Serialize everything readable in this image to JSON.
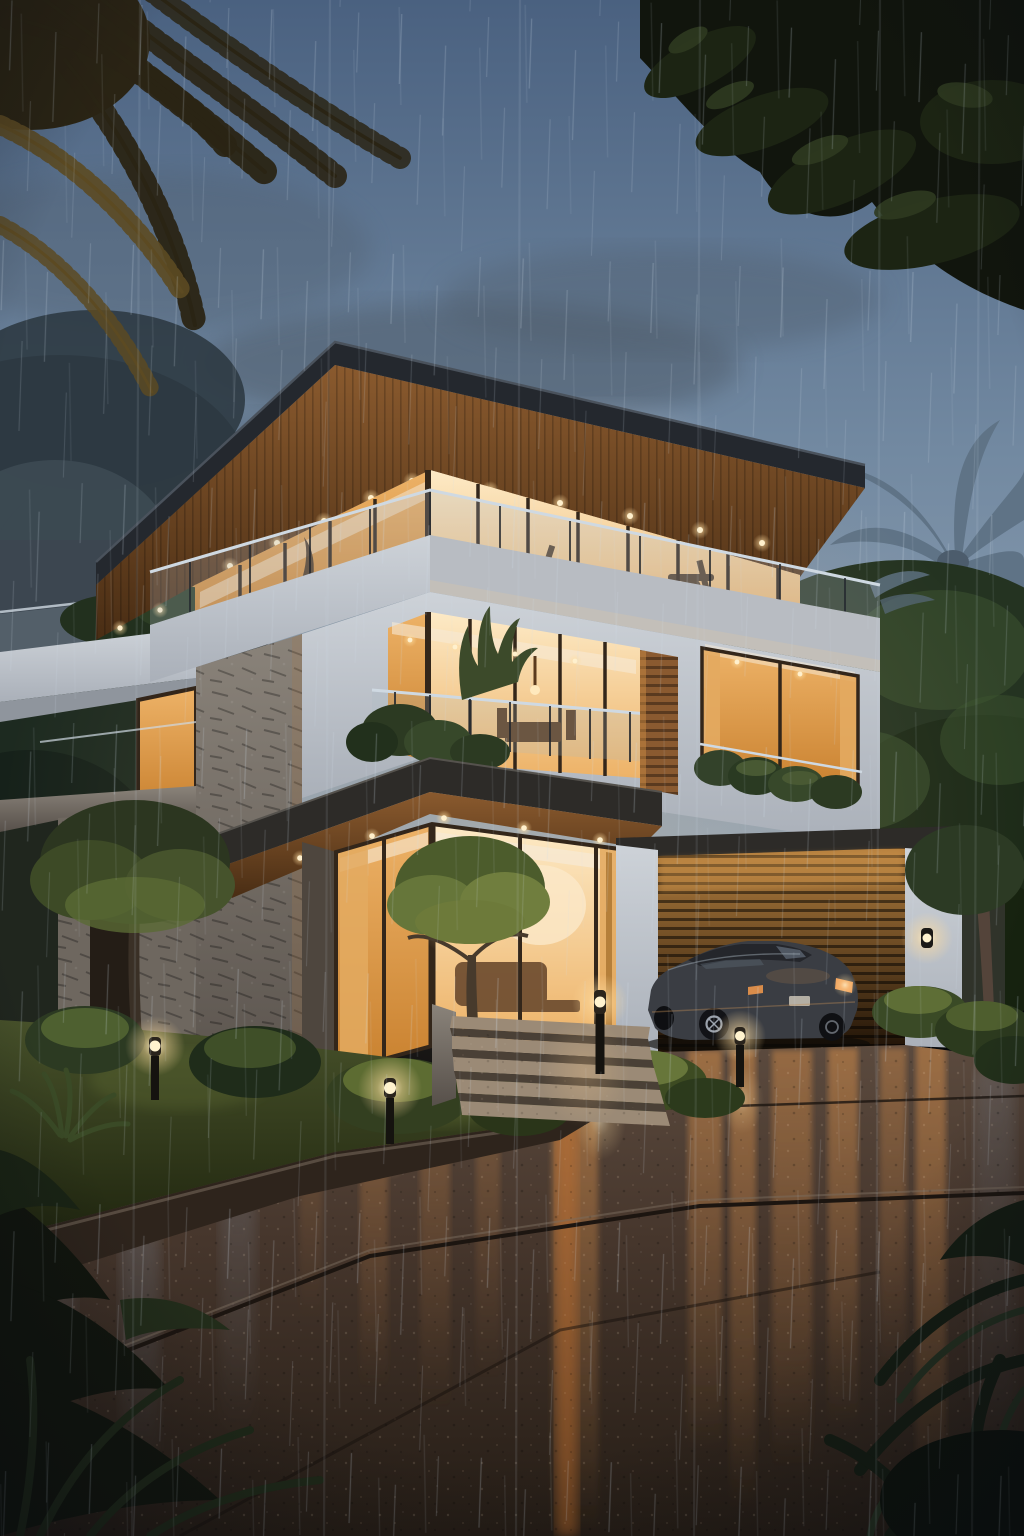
{
  "scene": {
    "description": "Modern three-storey tropical villa at dusk in heavy rain; warm interior lights glowing through floor-to-ceiling glass, cantilevered roofs with recessed downlights, glass balustrade balconies, stone-clad pillar, wooden slat garage with a dark sedan parked in front, bollard path lights in a lush garden, and a wet driveway reflecting the warm light. Palm fronds frame the top corners.",
    "width": 1024,
    "height": 1536,
    "objects": [
      "rainy dusk sky",
      "rain streaks",
      "storm clouds",
      "palm fronds silhouette",
      "tree canopy silhouette",
      "background trees",
      "royal palm tree",
      "modern villa",
      "cantilevered roof with downlights",
      "glass balustrade balcony",
      "floor-to-ceiling windows",
      "stone clad pillar",
      "wood slat pillar",
      "charcoal canopy slab",
      "ground floor living room windows",
      "entry steps",
      "wooden garage door",
      "dark sedan car",
      "wall sconce",
      "bollard path lights",
      "tropical garden",
      "lit shrubs and trees",
      "wet driveway with warm reflections",
      "pavement joint lines",
      "foreground agave leaves",
      "vignette"
    ]
  },
  "colors": {
    "sky_top": "#4a6180",
    "sky_mid": "#7289a1",
    "sky_horizon": "#9fadbb",
    "cloud": "#4e5a68",
    "mist": "#93a2b2",
    "rain": "#cfdce8",
    "foliage_silhouette": "#11150d",
    "foliage_dark": "#1f2c1a",
    "foliage_mid": "#31452a",
    "foliage_light": "#4e6636",
    "grass_lit": "#6d7a3a",
    "palm_frond_dark": "#2a2414",
    "palm_frond_lit": "#5c4a22",
    "palm_blue": "#5f7386",
    "tree_gray": "#2e3a42",
    "tree_gray_light": "#47565e",
    "roof_fascia": "#24282e",
    "roof_edge": "#4a525c",
    "soffit_light": "#8a5a2e",
    "soffit_dark": "#492d14",
    "window_bright": "#fdeac6",
    "window_warm": "#edb267",
    "window_deep": "#c9812f",
    "window_frame": "#33261a",
    "ceiling": "#f6ead6",
    "curtain": "#e3aa60",
    "wall_light": "#cdd2d8",
    "wall_shade": "#aab0b9",
    "slab_charcoal": "#2d2b28",
    "stone_light": "#8a837a",
    "stone_dark": "#57504a",
    "rail_steel": "#cfd9e2",
    "rail_glass": "#aab9c6",
    "wood_pillar": "#8a5a30",
    "garage_top": "#b5803f",
    "garage_bottom": "#1d1106",
    "car_body": "#3a3d43",
    "car_glass": "#6e7a88",
    "taillight": "#f0a05a",
    "plate": "#c9c2b4",
    "rim": "#9aa1ab",
    "grass_light": "#47512a",
    "grass_dark": "#20260f",
    "step_tread": "#9b8a76",
    "step_riser": "#4a4036",
    "drive_top": "#5b4a3e",
    "drive_mid": "#46362c",
    "drive_bottom": "#241c15",
    "refl_warm": "#d28c4a",
    "refl_orange": "#c9722e",
    "refl_blue": "#93a7bd",
    "light_glow": "#ffdda0",
    "light_core": "#fff3cf",
    "vignette": "#070a10"
  }
}
